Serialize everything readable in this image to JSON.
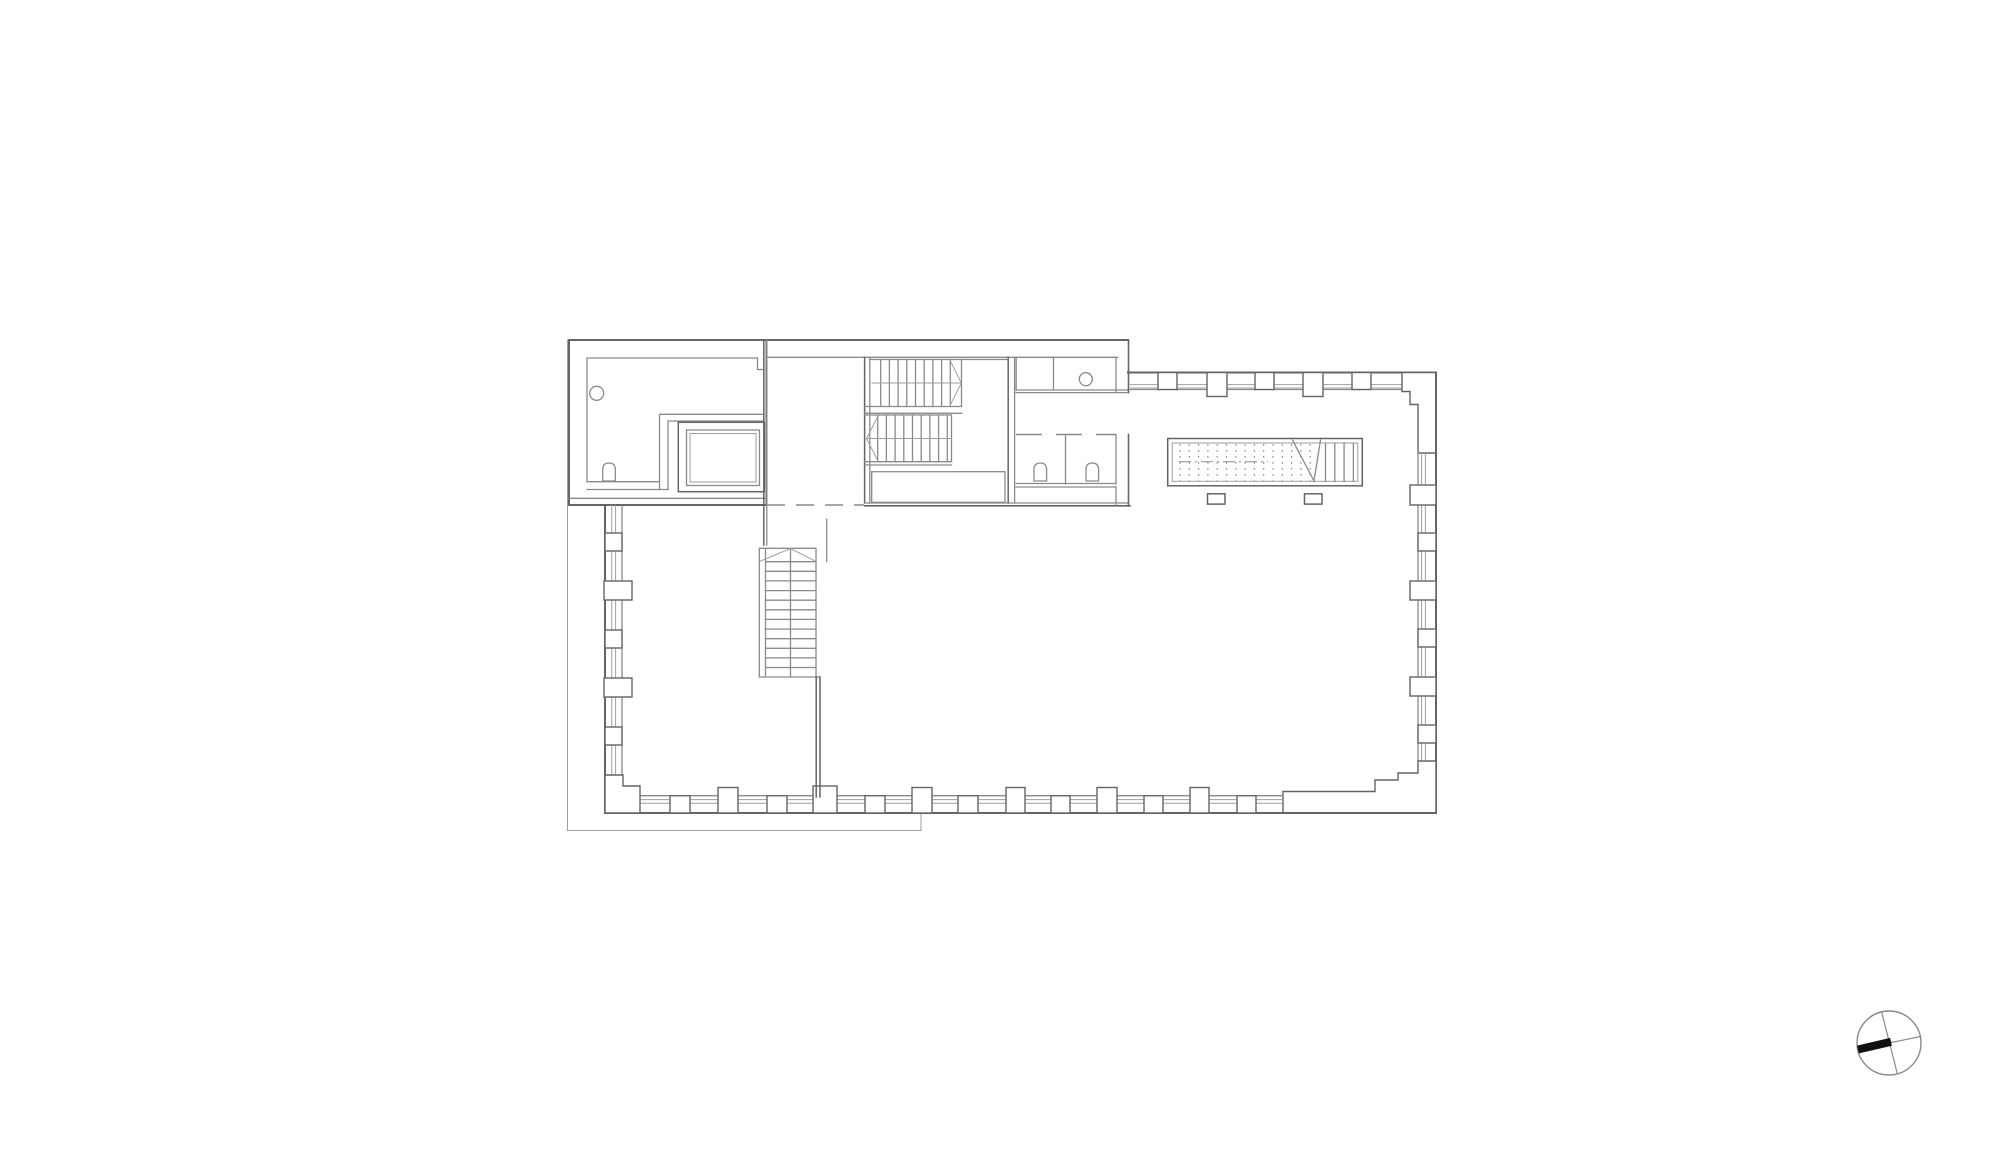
{
  "page": {
    "background": "#ffffff"
  },
  "colors": {
    "wall": "#646464",
    "inner": "#8a8a8a",
    "thin": "#9e9e9e",
    "north_bar": "#111111",
    "bg": "#ffffff"
  },
  "drawing": {
    "type": "architectural-floor-plan",
    "text_labels": [],
    "components": [
      {
        "name": "site-outline"
      },
      {
        "name": "service-room-block",
        "fixtures": [
          "sink",
          "toilet"
        ]
      },
      {
        "name": "elevator-shaft"
      },
      {
        "name": "stair-shaft-corridor"
      },
      {
        "name": "main-staircase-double-flight"
      },
      {
        "name": "toilet-rooms",
        "fixtures": [
          "sink",
          "toilet",
          "toilet"
        ]
      },
      {
        "name": "roof-access-stair-hatched"
      },
      {
        "name": "lower-staircase"
      },
      {
        "name": "perimeter-wall-with-window-piers",
        "sides": [
          "top",
          "right",
          "bottom",
          "left"
        ]
      },
      {
        "name": "north-arrow"
      }
    ]
  },
  "north_arrow": {
    "style": "circle-with-cross",
    "filled_arm_direction": "west-southwest"
  }
}
